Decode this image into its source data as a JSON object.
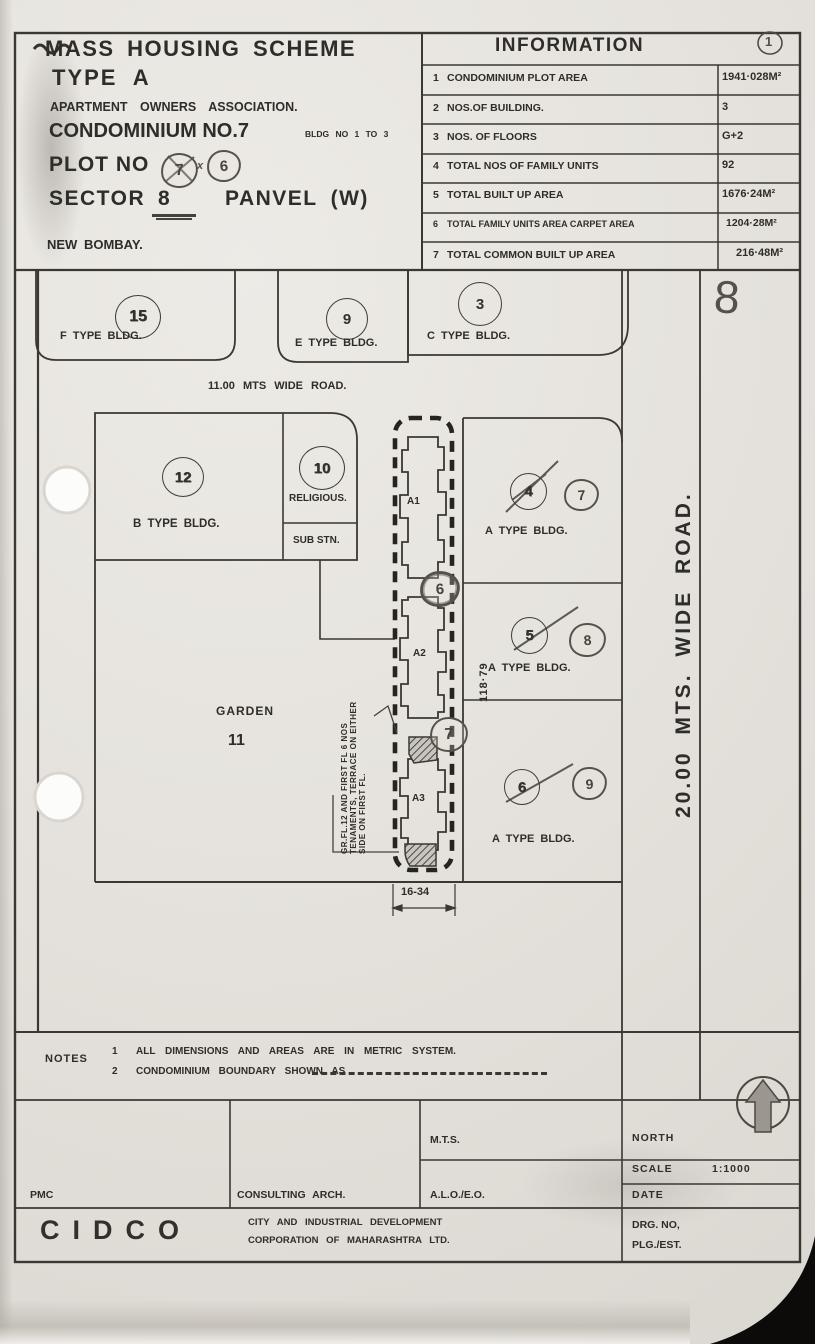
{
  "sheet": {
    "circle_no": "1"
  },
  "header": {
    "line1": "MASS HOUSING SCHEME",
    "line2": "TYPE A",
    "line3": "APARTMENT OWNERS ASSOCIATION.",
    "line4": "CONDOMINIUM NO.7",
    "line4b": "BLDG NO 1 TO 3",
    "plot_prefix": "PLOT NO",
    "plot_old": "7",
    "plot_cross": "x",
    "plot_new": "6",
    "sector_prefix": "SECTOR",
    "sector_no": "8",
    "sector_suffix": "PANVEL (W)",
    "city": "NEW BOMBAY."
  },
  "info": {
    "title": "INFORMATION",
    "rows": [
      {
        "no": "1",
        "label": "CONDOMINIUM PLOT AREA",
        "value": "1941·028M²"
      },
      {
        "no": "2",
        "label": "NOS.OF BUILDING.",
        "value": "3"
      },
      {
        "no": "3",
        "label": "NOS. OF FLOORS",
        "value": "G+2"
      },
      {
        "no": "4",
        "label": "TOTAL NOS OF FAMILY UNITS",
        "value": "92"
      },
      {
        "no": "5",
        "label": "TOTAL BUILT UP AREA",
        "value": "1676·24M²"
      },
      {
        "no": "6",
        "label": "TOTAL FAMILY UNITS AREA CARPET AREA",
        "value": "1204·28M²"
      },
      {
        "no": "7",
        "label": "TOTAL COMMON BUILT UP AREA",
        "value": "216·48M²"
      }
    ]
  },
  "plan": {
    "hand_sector": "8",
    "road_top": "11.00 MTS WIDE ROAD.",
    "road_right": "20.00 MTS. WIDE ROAD.",
    "top_plots": [
      {
        "number": "15",
        "label": "F TYPE BLDG."
      },
      {
        "number": "9",
        "label": "E TYPE BLDG."
      },
      {
        "number": "3",
        "label": "C TYPE BLDG."
      }
    ],
    "b_plot": {
      "number": "12",
      "label": "B TYPE BLDG."
    },
    "amenity": {
      "number": "10",
      "label1": "RELIGIOUS.",
      "label2": "SUB STN."
    },
    "garden": {
      "label": "GARDEN",
      "number": "11"
    },
    "a_plots": [
      {
        "old": "4",
        "new": "7",
        "label": "A TYPE BLDG."
      },
      {
        "old": "5",
        "new": "8",
        "label": "A TYPE BLDG."
      },
      {
        "old": "6",
        "new": "9",
        "label": "A TYPE BLDG."
      }
    ],
    "towers": [
      "A1",
      "A2",
      "A3"
    ],
    "hand_marks": [
      "6",
      "7"
    ],
    "dim_vertical": "118·79",
    "dim_bottom": "16-34",
    "annotation": [
      "GR.FL.12 AND FIRST FL 6 NOS",
      "TENAMENTS, TERRACE ON EITHER",
      "SIDE ON FIRST FL."
    ]
  },
  "notes": {
    "label": "NOTES",
    "items": [
      {
        "no": "1",
        "text": "ALL DIMENSIONS AND AREAS ARE IN METRIC SYSTEM."
      },
      {
        "no": "2",
        "text": "CONDOMINIUM BOUNDARY SHOWN AS"
      }
    ]
  },
  "title_block": {
    "pmc": "PMC",
    "consulting": "CONSULTING ARCH.",
    "mts": "M.T.S.",
    "alo": "A.L.O./E.O.",
    "north": "NORTH",
    "scale_label": "SCALE",
    "scale_value": "1:1000",
    "date_label": "DATE",
    "drg_line1": "DRG. NO,",
    "drg_line2": "PLG./EST.",
    "cidco": "CIDCO",
    "corp_line1": "CITY AND INDUSTRIAL DEVELOPMENT",
    "corp_line2": "CORPORATION OF MAHARASHTRA LTD."
  },
  "colors": {
    "paper": "#e6e3de",
    "ink": "#2f2d29",
    "pencil": "#54504a"
  }
}
